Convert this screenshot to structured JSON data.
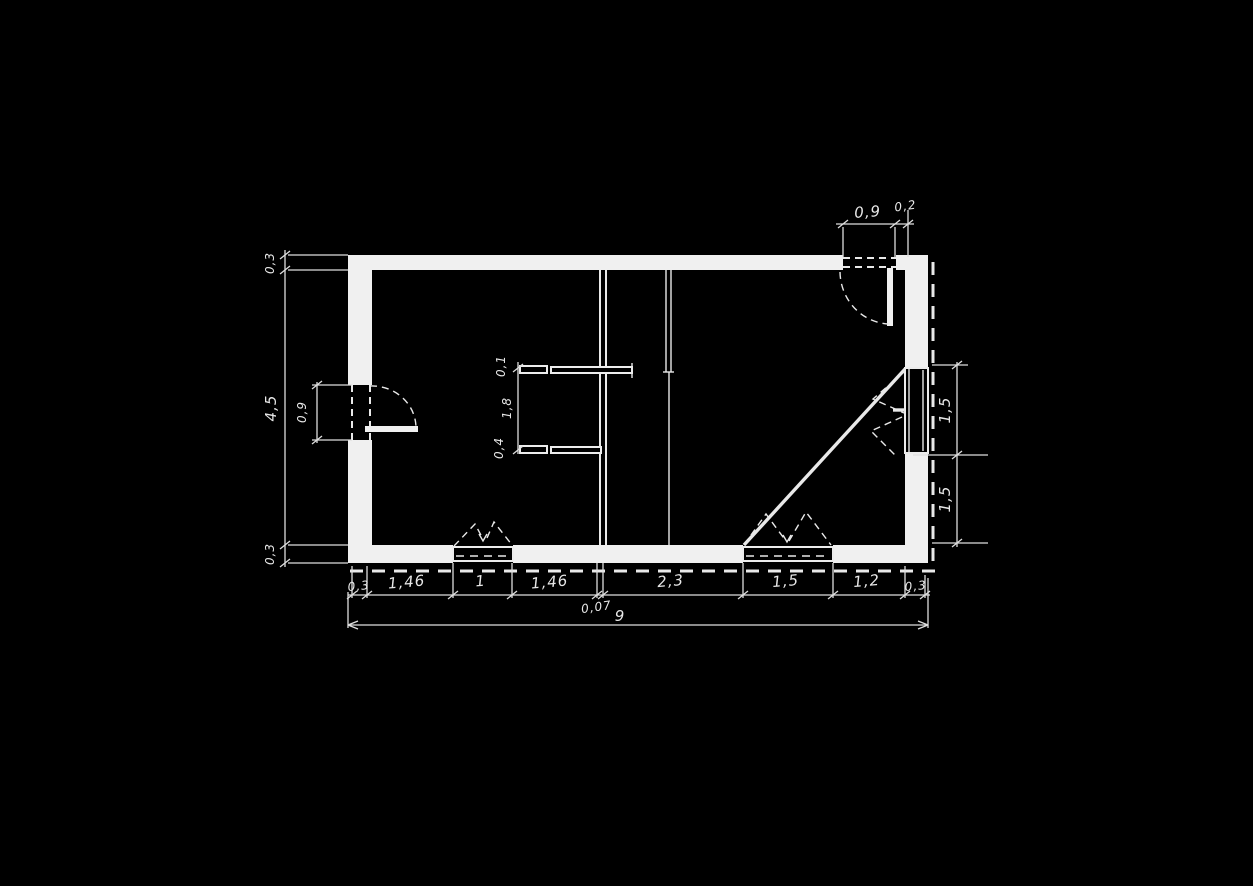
{
  "meta": {
    "drawing_type": "hand-drawn architectural floor plan (scan, white ink on black)",
    "background_color": "#000000",
    "ink_color": "#ededed"
  },
  "dimensions": {
    "total_width": "9",
    "left_chain": [
      "0,3",
      "4,5",
      "0,3"
    ],
    "left_door_width": "0,9",
    "top_door_chain": [
      "0,9",
      "0,2"
    ],
    "interior_chain": [
      "0,1",
      "1,8",
      "0,4"
    ],
    "right_chain": [
      "1,5",
      "1,5"
    ],
    "bottom_chain": [
      "0,3",
      "1,46",
      "1",
      "1,46",
      "0,07",
      "2,3",
      "1,5",
      "1,2",
      "0,3"
    ]
  }
}
